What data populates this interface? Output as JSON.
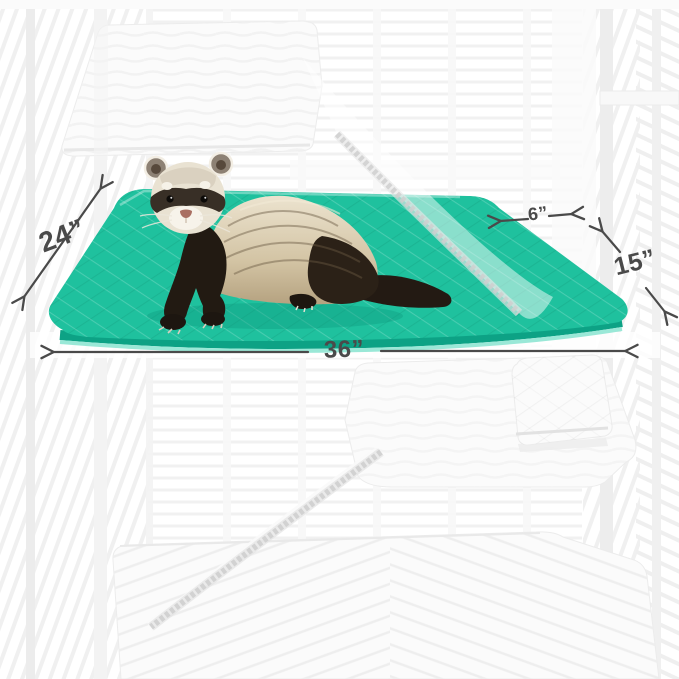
{
  "image": {
    "alt": "Ferret standing on a teal quilted cage liner mat inside a white wire cage with white quilted liners on other levels, ramps between levels, and dimension arrows"
  },
  "dimensions": {
    "depth": "24”",
    "ramp_width": "6”",
    "small_mat": "15”",
    "width": "36”"
  },
  "colors": {
    "mat_teal": "#1fc19e",
    "mat_teal_shadow": "#0da285",
    "mat_teal_rim": "#9ae8d7",
    "arrow": "#4a4a4a",
    "speckle": "#cfcfcf",
    "mat_white": "#fbfbfb",
    "cage_line": "#f0f0f0",
    "ferret_dark": "#241c14",
    "ferret_cream": "#e9e2d2"
  }
}
